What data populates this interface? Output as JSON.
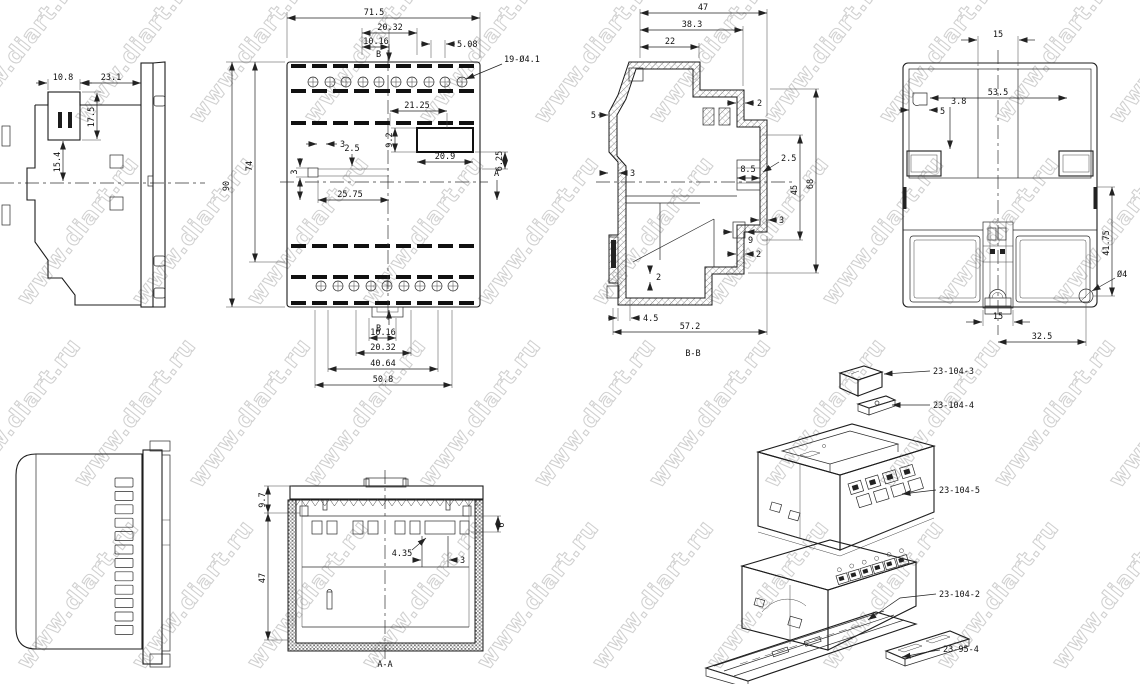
{
  "watermark": {
    "text": "www.diart.ru",
    "color": "#c8c8c8"
  },
  "views": {
    "side_left": {
      "dims": {
        "d108": "10.8",
        "d231": "23.1",
        "d175": "17.5",
        "d154": "15.4"
      }
    },
    "front": {
      "dims": {
        "w": "71.5",
        "t2032": "20.32",
        "t1016": "10.16",
        "t508": "5.08",
        "holes": "19-Ø4.1",
        "m2125": "21.25",
        "m92": "9.2",
        "m3h": "3",
        "m25": "2.5",
        "m3v": "3",
        "m209": "20.9",
        "m625": "6.25",
        "m2575": "25.75",
        "h90": "90",
        "h74": "74",
        "b1016": "10.16",
        "b2032": "20.32",
        "b4064": "40.64",
        "b508": "50.8"
      },
      "section_b": "B",
      "section_a": "A"
    },
    "section_bb": {
      "label": "B-B",
      "dims": {
        "d47": "47",
        "d383": "38.3",
        "d22": "22",
        "d2a": "2",
        "d5": "5",
        "d3l": "3",
        "d85": "8.5",
        "d25": "2.5",
        "d45": "45",
        "d68": "68",
        "d3r": "3",
        "d9": "9",
        "d2b": "2",
        "d2c": "2",
        "d45b": "4.5",
        "d572": "57.2"
      }
    },
    "rear": {
      "dims": {
        "d15t": "15",
        "d535": "53.5",
        "d5": "5",
        "d38": "3.8",
        "d4175": "41.75",
        "hole": "Ø4",
        "d15b": "15",
        "d325": "32.5"
      }
    },
    "section_aa": {
      "label": "A-A",
      "dims": {
        "d97": "9.7",
        "d47": "47",
        "d6": "6",
        "d435": "4.35",
        "d3": "3"
      }
    },
    "exploded": {
      "callouts": [
        "23-104-3",
        "23-104-4",
        "23-104-5",
        "23-104-2",
        "23-95-4"
      ]
    }
  }
}
